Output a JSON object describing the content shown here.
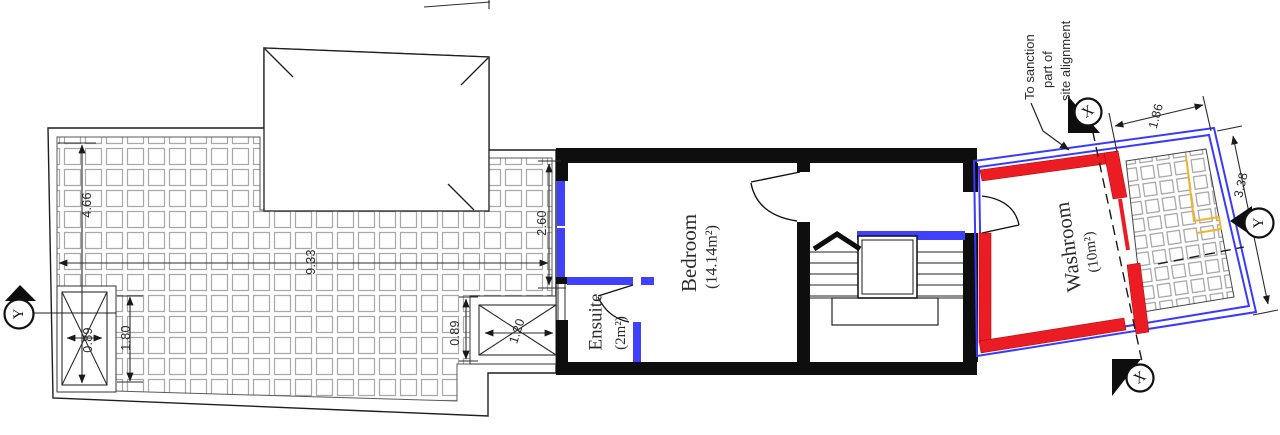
{
  "rooms": {
    "bedroom": {
      "name": "Bedroom",
      "area": "(14.14m²)"
    },
    "ensuite": {
      "name": "Ensuite",
      "area": "(2m²)"
    },
    "washroom": {
      "name": "Washroom",
      "area": "(10m²)"
    }
  },
  "dimensions": {
    "terrace_height": "4.66",
    "terrace_length": "9.33",
    "shaft_width": "0.89",
    "shaft_side": "1.80",
    "planter_height": "0.89",
    "planter_width": "1.20",
    "window_width": "2.60",
    "rear_terrace_width": "1.86",
    "rear_terrace_length": "3.38"
  },
  "section_markers": {
    "x": "X",
    "y": "Y"
  },
  "note": {
    "line1": "To sanction",
    "line2": "part of",
    "line3": "site alignment"
  },
  "colors": {
    "wall_black": "#0e0e0e",
    "window_blue": "#4040ff",
    "sanction_red": "#ec1c24",
    "fixture_yellow": "#f0b429",
    "hatch_gray": "#a8a8a8",
    "bedroom_label_blue": "#2a2ae0"
  }
}
